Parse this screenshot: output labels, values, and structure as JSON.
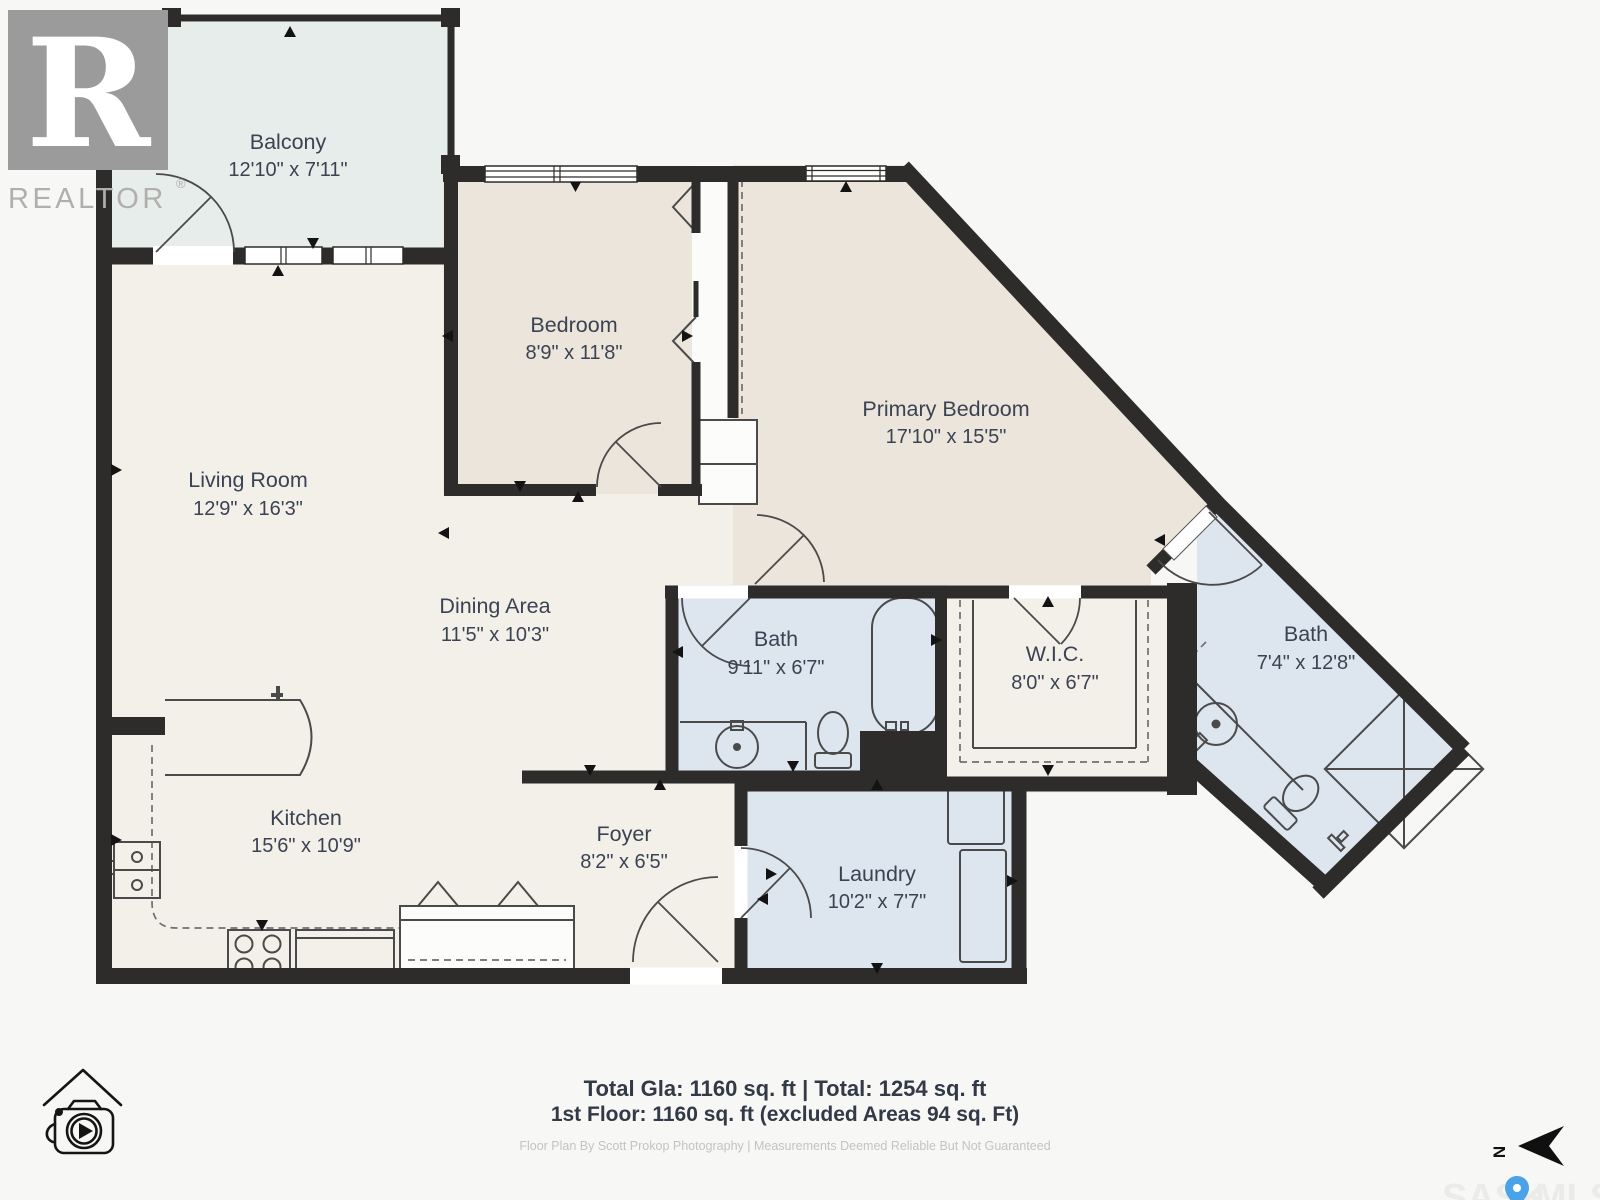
{
  "branding": {
    "realtor_logo_letter": "R",
    "realtor_wordmark": "REALTOR",
    "registered_symbol": "®"
  },
  "rooms": [
    {
      "id": "balcony",
      "name": "Balcony",
      "dims": "12'10\" x 7'11\""
    },
    {
      "id": "living-room",
      "name": "Living Room",
      "dims": "12'9\" x 16'3\""
    },
    {
      "id": "bedroom",
      "name": "Bedroom",
      "dims": "8'9\" x 11'8\""
    },
    {
      "id": "primary-bedroom",
      "name": "Primary Bedroom",
      "dims": "17'10\" x 15'5\""
    },
    {
      "id": "dining-area",
      "name": "Dining Area",
      "dims": "11'5\" x 10'3\""
    },
    {
      "id": "bath-main",
      "name": "Bath",
      "dims": "9'11\" x 6'7\""
    },
    {
      "id": "wic",
      "name": "W.I.C.",
      "dims": "8'0\" x 6'7\""
    },
    {
      "id": "bath-ensuite",
      "name": "Bath",
      "dims": "7'4\" x 12'8\""
    },
    {
      "id": "kitchen",
      "name": "Kitchen",
      "dims": "15'6\" x 10'9\""
    },
    {
      "id": "foyer",
      "name": "Foyer",
      "dims": "8'2\" x 6'5\""
    },
    {
      "id": "laundry",
      "name": "Laundry",
      "dims": "10'2\" x 7'7\""
    }
  ],
  "footer": {
    "line1": "Total Gla: 1160 sq. ft | Total: 1254 sq. ft",
    "line2": "1st Floor: 1160 sq. ft (excluded Areas 94 sq. Ft)",
    "credit": "Floor Plan By Scott Prokop Photography | Measurements Deemed Reliable But Not Guaranteed"
  },
  "compass": {
    "north_label": "N"
  },
  "watermark": {
    "text_left": "SASK",
    "text_right": "MLS"
  },
  "colors": {
    "wall": "#2d2c2a",
    "open_floor": "#f3f0e9",
    "bedroom_floor": "#ebe5db",
    "bath_floor": "#dde5ee",
    "balcony_floor": "#e7edea",
    "label_text": "#3b4353",
    "pin_blue": "#4aa3e8"
  }
}
